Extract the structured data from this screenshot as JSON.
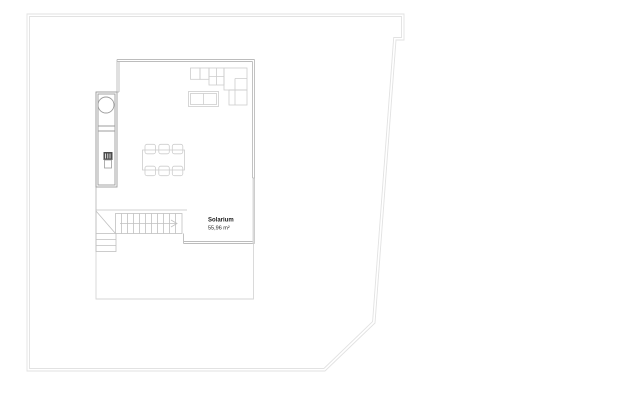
{
  "floor_plan": {
    "room": {
      "name": "Solarium",
      "area_label": "55,96 m²"
    },
    "colors": {
      "background": "#ffffff",
      "plot_boundary": "#e2e2e2",
      "wall": "#bcbcbc",
      "parapet_fill": "#dadada",
      "terrace_line": "#d6d6d6",
      "casework": "#9c9c9c",
      "furniture": "#cdcdcd",
      "stairs": "#c0c0c0",
      "fixture": "#4d4d4d",
      "fixture_detail": "#ffffff",
      "text": "#1a1a1a"
    }
  }
}
